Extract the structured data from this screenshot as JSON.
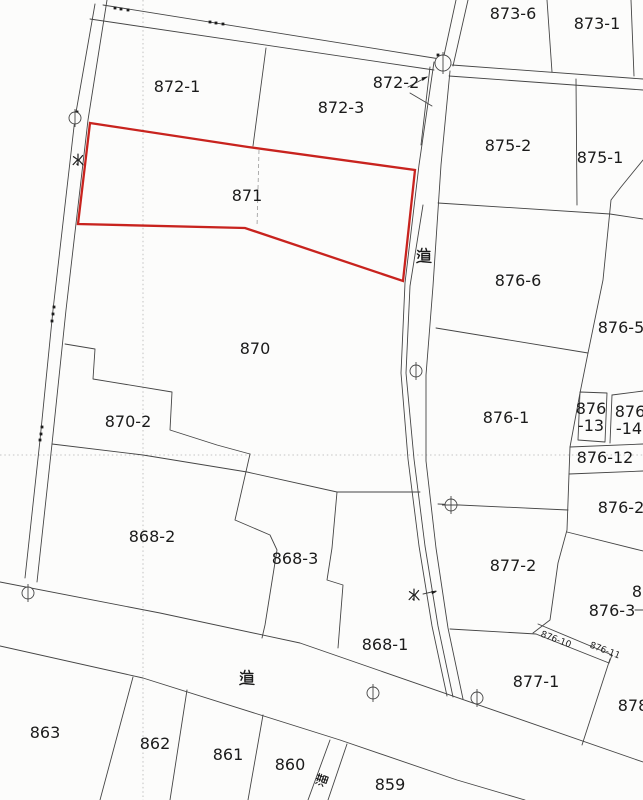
{
  "map": {
    "red_parcel": {
      "label": "871",
      "points": "90,123 248,147 415,170 403,281 245,228 78,224",
      "color": "#c8231e"
    },
    "parcel_labels": [
      {
        "label": "873-6",
        "x": 513,
        "y": 19
      },
      {
        "label": "873-1",
        "x": 597,
        "y": 29
      },
      {
        "label": "872-1",
        "x": 177,
        "y": 92
      },
      {
        "label": "872-2",
        "x": 396,
        "y": 88
      },
      {
        "label": "872-3",
        "x": 341,
        "y": 113
      },
      {
        "label": "875-2",
        "x": 508,
        "y": 151
      },
      {
        "label": "875-1",
        "x": 600,
        "y": 163
      },
      {
        "label": "871",
        "x": 247,
        "y": 201
      },
      {
        "label": "876-6",
        "x": 518,
        "y": 286
      },
      {
        "label": "876-5",
        "x": 621,
        "y": 333
      },
      {
        "label": "870",
        "x": 255,
        "y": 354
      },
      {
        "label": "876-1",
        "x": 506,
        "y": 423
      },
      {
        "label": "876",
        "x": 591,
        "y": 414
      },
      {
        "label": "-13",
        "x": 591,
        "y": 431
      },
      {
        "label": "876",
        "x": 630,
        "y": 417
      },
      {
        "label": "-14",
        "x": 629,
        "y": 434
      },
      {
        "label": "870-2",
        "x": 128,
        "y": 427
      },
      {
        "label": "876-12",
        "x": 605,
        "y": 463
      },
      {
        "label": "876-2",
        "x": 621,
        "y": 513
      },
      {
        "label": "868-2",
        "x": 152,
        "y": 542
      },
      {
        "label": "868-3",
        "x": 295,
        "y": 564
      },
      {
        "label": "877-2",
        "x": 513,
        "y": 571
      },
      {
        "label": "8",
        "x": 637,
        "y": 597
      },
      {
        "label": "876-3",
        "x": 612,
        "y": 616
      },
      {
        "label": "876-10",
        "x": 555,
        "y": 642,
        "rot": 21,
        "size": 9
      },
      {
        "label": "876-11",
        "x": 604,
        "y": 653,
        "rot": 21,
        "size": 9
      },
      {
        "label": "868-1",
        "x": 385,
        "y": 650
      },
      {
        "label": "877-1",
        "x": 536,
        "y": 687
      },
      {
        "label": "878",
        "x": 633,
        "y": 711
      },
      {
        "label": "863",
        "x": 45,
        "y": 738
      },
      {
        "label": "862",
        "x": 155,
        "y": 749
      },
      {
        "label": "861",
        "x": 228,
        "y": 760
      },
      {
        "label": "860",
        "x": 290,
        "y": 770
      },
      {
        "label": "859",
        "x": 390,
        "y": 790
      }
    ],
    "annotations": [
      {
        "glyph": "mizu",
        "label": "水",
        "x": 78,
        "y": 160,
        "size": 14
      },
      {
        "glyph": "michi",
        "label": "道",
        "x": 424,
        "y": 256,
        "size": 17
      },
      {
        "glyph": "mizu",
        "label": "水",
        "x": 414,
        "y": 595,
        "size": 14
      },
      {
        "glyph": "michi",
        "label": "道",
        "x": 247,
        "y": 678,
        "size": 17
      },
      {
        "glyph": "mizo",
        "label": "溝",
        "x": 322,
        "y": 780,
        "size": 13,
        "rot": -70
      }
    ],
    "survey_markers": [
      {
        "x": 75,
        "y": 118,
        "r": 6
      },
      {
        "x": 443,
        "y": 63,
        "r": 8
      },
      {
        "x": 416,
        "y": 371,
        "r": 6
      },
      {
        "x": 451,
        "y": 505,
        "r": 6,
        "cross": true
      },
      {
        "x": 373,
        "y": 693,
        "r": 6
      },
      {
        "x": 477,
        "y": 698,
        "r": 6
      },
      {
        "x": 28,
        "y": 593,
        "r": 6
      }
    ],
    "boundary_dots": [
      [
        115,
        8
      ],
      [
        121,
        9
      ],
      [
        128,
        10
      ],
      [
        210,
        22
      ],
      [
        216,
        23
      ],
      [
        223,
        24
      ],
      [
        438,
        55
      ],
      [
        77,
        112
      ],
      [
        76,
        121
      ],
      [
        54,
        307
      ],
      [
        53,
        314
      ],
      [
        52,
        321
      ],
      [
        42,
        427
      ],
      [
        41,
        434
      ],
      [
        40,
        440
      ]
    ]
  }
}
